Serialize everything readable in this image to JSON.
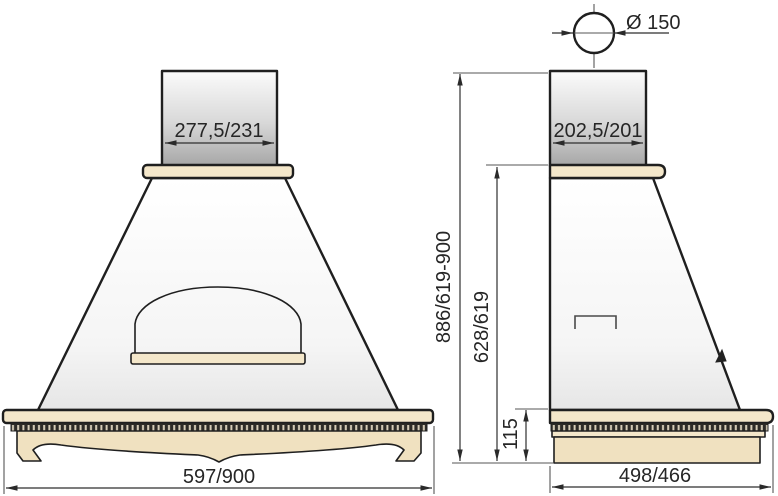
{
  "dimensions": {
    "duct_diameter": "Ø 150",
    "front_chimney_width": "277,5/231",
    "front_base_width": "597/900",
    "side_chimney_depth": "202,5/201",
    "side_total_height": "886/619-900",
    "side_body_height": "628/619",
    "side_base_height": "115",
    "side_base_depth": "498/466"
  },
  "colors": {
    "wood_light": "#f4e7ca",
    "wood_dark": "#f0e1c0",
    "outline": "#1f1f1f",
    "metal_dark": "#a8a8a8"
  }
}
